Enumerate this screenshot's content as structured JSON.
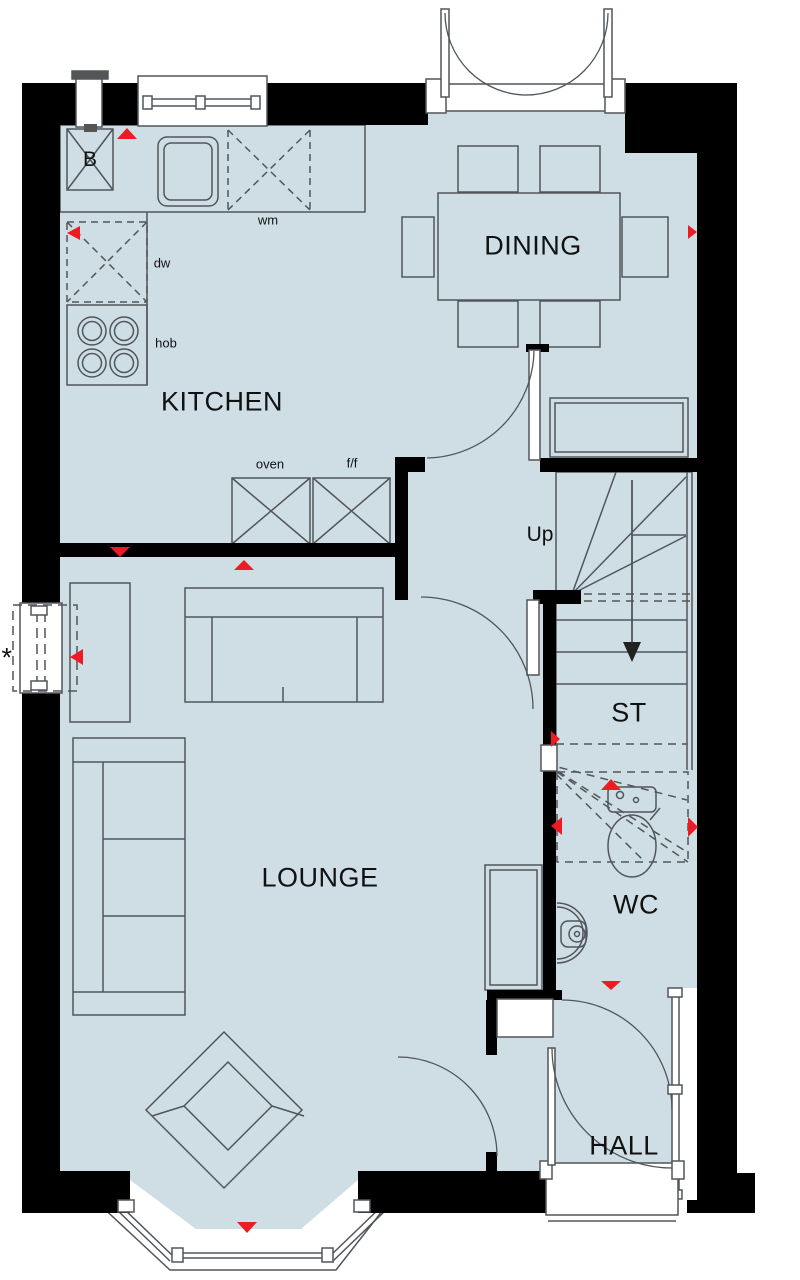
{
  "plan": {
    "title": "Ground floor plan",
    "rooms": {
      "kitchen": "KITCHEN",
      "dining": "DINING",
      "lounge": "LOUNGE",
      "hall": "HALL",
      "wc": "WC",
      "storage": "ST"
    },
    "annotations": {
      "stairs_direction": "Up",
      "boiler": "B",
      "washing_machine": "wm",
      "dishwasher": "dw",
      "hob": "hob",
      "oven": "oven",
      "fridge_freezer": "f/f",
      "optional_window_marker": "*"
    },
    "colors": {
      "floor": "#cfdee5",
      "wall": "#000000",
      "furniture_line": "#50565a",
      "marker_red": "#ed1c24"
    }
  }
}
